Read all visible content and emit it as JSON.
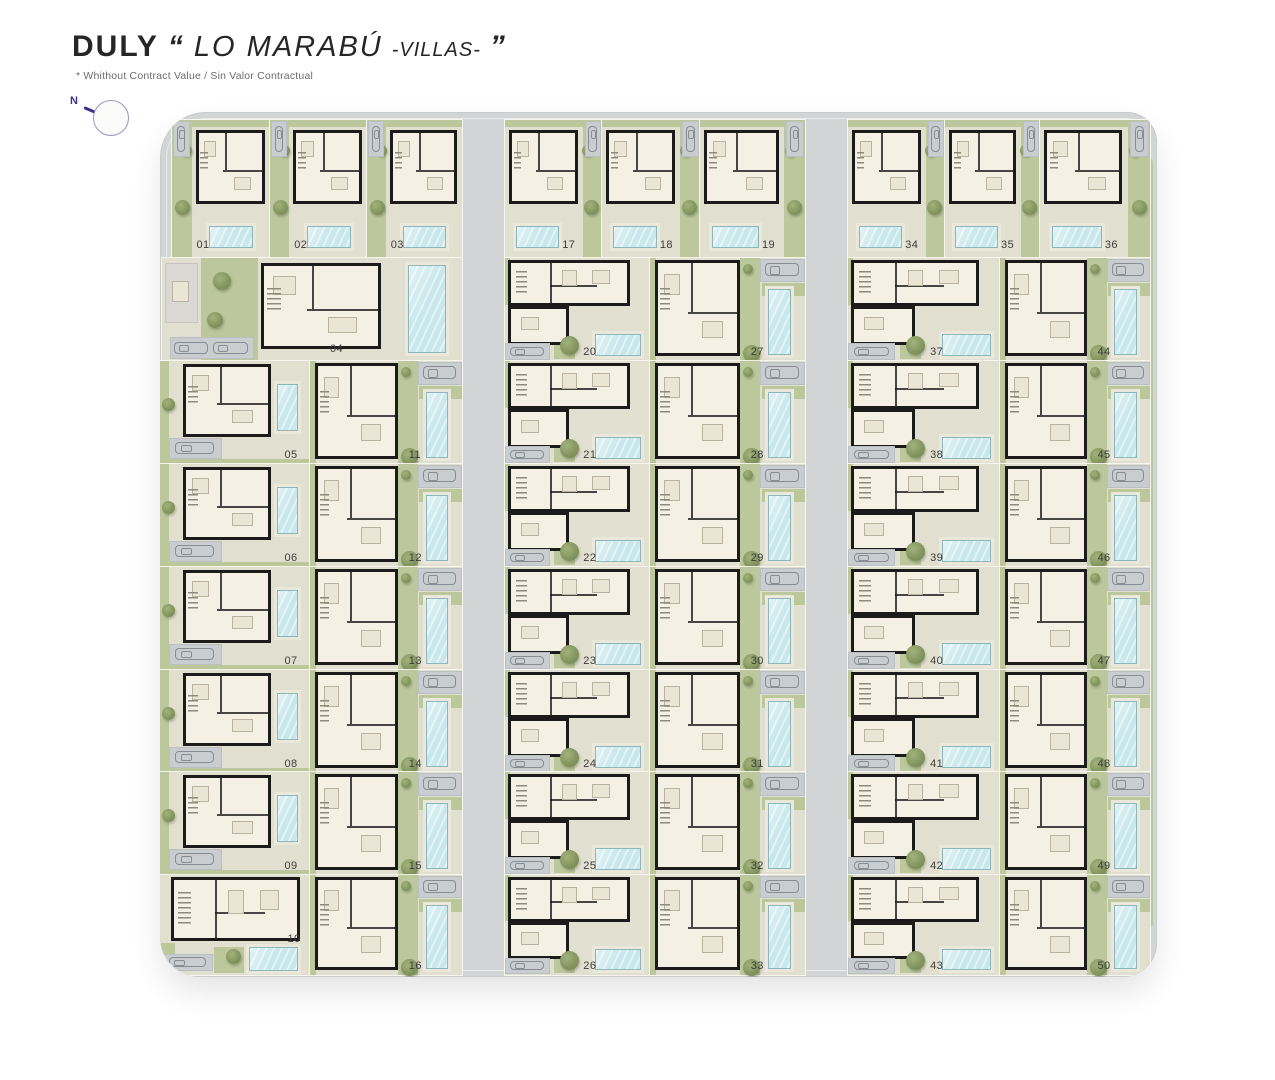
{
  "header": {
    "brand": "DULY",
    "open_quote": "“",
    "project": "LO MARABÚ",
    "suffix": "-VILLAS-",
    "close_quote": "”",
    "subtitle": "* Whithout Contract Value / Sin Valor Contractual"
  },
  "compass": {
    "north_label": "N"
  },
  "colors": {
    "road": "#d2d4d6",
    "plot": "#e1dfd0",
    "garden": "#bcc79c",
    "pool": "#c9e8ec",
    "wall": "#1b1b1b",
    "house": "#f4f0e3",
    "parking": "#c9cdd0",
    "number": "#3d3d3d",
    "tree": "#7c8f58",
    "treeLight": "#a3b27c",
    "compass": "#3c2f87"
  },
  "villas": [
    {
      "num": "01",
      "type": "top",
      "m": true,
      "x": 172,
      "y": 120,
      "w": 98,
      "h": 138
    },
    {
      "num": "02",
      "type": "top",
      "m": true,
      "x": 270,
      "y": 120,
      "w": 97,
      "h": 138
    },
    {
      "num": "03",
      "type": "top",
      "m": true,
      "x": 367,
      "y": 120,
      "w": 95,
      "h": 138
    },
    {
      "num": "04",
      "type": "s04",
      "x": 162,
      "y": 258,
      "w": 300,
      "h": 103
    },
    {
      "num": "05",
      "type": "pb",
      "x": 160,
      "y": 361,
      "w": 150,
      "h": 103
    },
    {
      "num": "06",
      "type": "pb",
      "x": 160,
      "y": 464,
      "w": 150,
      "h": 103
    },
    {
      "num": "07",
      "type": "pb",
      "x": 160,
      "y": 567,
      "w": 150,
      "h": 103
    },
    {
      "num": "08",
      "type": "pb",
      "x": 160,
      "y": 670,
      "w": 150,
      "h": 103
    },
    {
      "num": "09",
      "type": "pb",
      "x": 160,
      "y": 772,
      "w": 150,
      "h": 103
    },
    {
      "num": "10",
      "type": "wide10",
      "x": 160,
      "y": 875,
      "w": 150,
      "h": 100
    },
    {
      "num": "11",
      "type": "pt",
      "x": 310,
      "y": 361,
      "w": 152,
      "h": 103
    },
    {
      "num": "12",
      "type": "pt",
      "x": 310,
      "y": 464,
      "w": 152,
      "h": 103
    },
    {
      "num": "13",
      "type": "pt",
      "x": 310,
      "y": 567,
      "w": 152,
      "h": 103
    },
    {
      "num": "14",
      "type": "pt",
      "x": 310,
      "y": 670,
      "w": 152,
      "h": 103
    },
    {
      "num": "15",
      "type": "pt",
      "x": 310,
      "y": 772,
      "w": 152,
      "h": 103
    },
    {
      "num": "16",
      "type": "pt",
      "x": 310,
      "y": 875,
      "w": 152,
      "h": 100
    },
    {
      "num": "17",
      "type": "top",
      "x": 505,
      "y": 120,
      "w": 97,
      "h": 138
    },
    {
      "num": "18",
      "type": "top",
      "x": 602,
      "y": 120,
      "w": 98,
      "h": 138
    },
    {
      "num": "19",
      "type": "top",
      "x": 700,
      "y": 120,
      "w": 105,
      "h": 138
    },
    {
      "num": "20",
      "type": "wide",
      "x": 505,
      "y": 258,
      "w": 145,
      "h": 103
    },
    {
      "num": "21",
      "type": "wide",
      "x": 505,
      "y": 361,
      "w": 145,
      "h": 103
    },
    {
      "num": "22",
      "type": "wide",
      "x": 505,
      "y": 464,
      "w": 145,
      "h": 103
    },
    {
      "num": "23",
      "type": "wide",
      "x": 505,
      "y": 567,
      "w": 145,
      "h": 103
    },
    {
      "num": "24",
      "type": "wide",
      "x": 505,
      "y": 670,
      "w": 145,
      "h": 103
    },
    {
      "num": "25",
      "type": "wide",
      "x": 505,
      "y": 772,
      "w": 145,
      "h": 103
    },
    {
      "num": "26",
      "type": "wide",
      "x": 505,
      "y": 875,
      "w": 145,
      "h": 100
    },
    {
      "num": "27",
      "type": "pt",
      "x": 650,
      "y": 258,
      "w": 155,
      "h": 103
    },
    {
      "num": "28",
      "type": "pt",
      "x": 650,
      "y": 361,
      "w": 155,
      "h": 103
    },
    {
      "num": "29",
      "type": "pt",
      "x": 650,
      "y": 464,
      "w": 155,
      "h": 103
    },
    {
      "num": "30",
      "type": "pt",
      "x": 650,
      "y": 567,
      "w": 155,
      "h": 103
    },
    {
      "num": "31",
      "type": "pt",
      "x": 650,
      "y": 670,
      "w": 155,
      "h": 103
    },
    {
      "num": "32",
      "type": "pt",
      "x": 650,
      "y": 772,
      "w": 155,
      "h": 103
    },
    {
      "num": "33",
      "type": "pt",
      "x": 650,
      "y": 875,
      "w": 155,
      "h": 100
    },
    {
      "num": "34",
      "type": "top",
      "x": 848,
      "y": 120,
      "w": 97,
      "h": 138
    },
    {
      "num": "35",
      "type": "top",
      "x": 945,
      "y": 120,
      "w": 95,
      "h": 138
    },
    {
      "num": "36",
      "type": "top",
      "x": 1040,
      "y": 120,
      "w": 110,
      "h": 138
    },
    {
      "num": "37",
      "type": "wide",
      "x": 848,
      "y": 258,
      "w": 152,
      "h": 103
    },
    {
      "num": "38",
      "type": "wide",
      "x": 848,
      "y": 361,
      "w": 152,
      "h": 103
    },
    {
      "num": "39",
      "type": "wide",
      "x": 848,
      "y": 464,
      "w": 152,
      "h": 103
    },
    {
      "num": "40",
      "type": "wide",
      "x": 848,
      "y": 567,
      "w": 152,
      "h": 103
    },
    {
      "num": "41",
      "type": "wide",
      "x": 848,
      "y": 670,
      "w": 152,
      "h": 103
    },
    {
      "num": "42",
      "type": "wide",
      "x": 848,
      "y": 772,
      "w": 152,
      "h": 103
    },
    {
      "num": "43",
      "type": "wide",
      "x": 848,
      "y": 875,
      "w": 152,
      "h": 100
    },
    {
      "num": "44",
      "type": "pt",
      "x": 1000,
      "y": 258,
      "w": 150,
      "h": 103
    },
    {
      "num": "45",
      "type": "pt",
      "x": 1000,
      "y": 361,
      "w": 150,
      "h": 103
    },
    {
      "num": "46",
      "type": "pt",
      "x": 1000,
      "y": 464,
      "w": 150,
      "h": 103
    },
    {
      "num": "47",
      "type": "pt",
      "x": 1000,
      "y": 567,
      "w": 150,
      "h": 103
    },
    {
      "num": "48",
      "type": "pt",
      "x": 1000,
      "y": 670,
      "w": 150,
      "h": 103
    },
    {
      "num": "49",
      "type": "pt",
      "x": 1000,
      "y": 772,
      "w": 150,
      "h": 103
    },
    {
      "num": "50",
      "type": "pt",
      "x": 1000,
      "y": 875,
      "w": 150,
      "h": 100
    }
  ]
}
